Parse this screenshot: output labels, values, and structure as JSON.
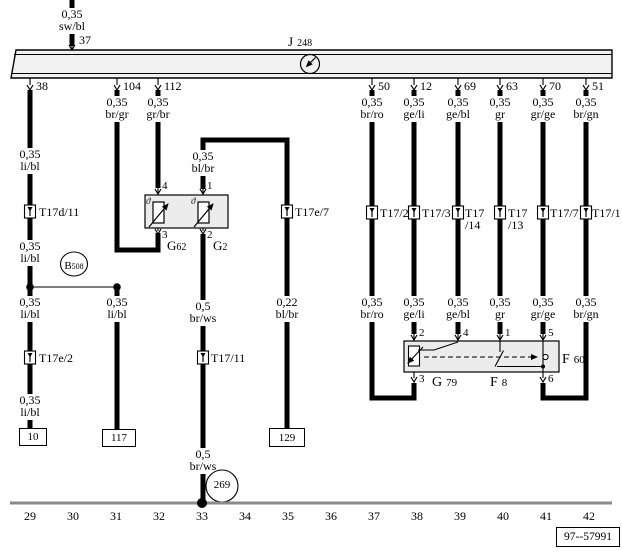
{
  "meta": {
    "diagram_number": "97--57991"
  },
  "bus": {
    "component_letter": "J",
    "component_number": "248",
    "top_pin": "37",
    "pins": [
      "38",
      "104",
      "112",
      "50",
      "12",
      "69",
      "63",
      "70",
      "51"
    ]
  },
  "wires": {
    "sw_bl": {
      "size": "0,35",
      "color": "sw/bl"
    },
    "li_bl": {
      "size": "0,35",
      "color": "li/bl"
    },
    "br_gr": {
      "size": "0,35",
      "color": "br/gr"
    },
    "gr_br": {
      "size": "0,35",
      "color": "gr/br"
    },
    "bl_br": {
      "size": "0,35",
      "color": "bl/br"
    },
    "bl_br_thin": {
      "size": "0,22",
      "color": "bl/br"
    },
    "br_ws": {
      "size": "0,5",
      "color": "br/ws"
    },
    "br_ro": {
      "size": "0,35",
      "color": "br/ro"
    },
    "ge_li": {
      "size": "0,35",
      "color": "ge/li"
    },
    "ge_bl": {
      "size": "0,35",
      "color": "ge/bl"
    },
    "gr": {
      "size": "0,35",
      "color": "gr"
    },
    "gr_ge": {
      "size": "0,35",
      "color": "gr/ge"
    },
    "br_gn": {
      "size": "0,35",
      "color": "br/gn"
    }
  },
  "connectors": {
    "t17d_11": "T17d/11",
    "t17e_2": "T17e/2",
    "t17_11": "T17/11",
    "t17e_7": "T17e/7",
    "t17_2": "T17/2",
    "t17_3": "T17/3",
    "t17_14_line1": "T17",
    "t17_14_line2": "/14",
    "t17_13_line1": "T17",
    "t17_13_line2": "/13",
    "t17_7": "T17/7",
    "t17_1": "T17/1"
  },
  "components": {
    "g62": {
      "letter": "G",
      "number": "62"
    },
    "g2": {
      "letter": "G",
      "number": "2"
    },
    "g79": {
      "letter": "G",
      "number": "79"
    },
    "f8": {
      "letter": "F",
      "number": "8"
    },
    "f60": {
      "letter": "F",
      "number": "60"
    },
    "b508": {
      "letter": "B",
      "number": "508"
    },
    "theta": "ϑ"
  },
  "component_pins": {
    "g62_top": "4",
    "g2_top": "1",
    "g62_bottom": "3",
    "g2_bottom": "2",
    "g79_top": "2",
    "g79_wiper": "4",
    "f8_top": "1",
    "f60_top": "5",
    "g79_bottom": "3",
    "f60_bottom": "6"
  },
  "terminals": {
    "t10": "10",
    "t117": "117",
    "t129": "129",
    "ground_269": "269"
  },
  "tracks": [
    "29",
    "30",
    "31",
    "32",
    "33",
    "34",
    "35",
    "36",
    "37",
    "38",
    "39",
    "40",
    "41",
    "42"
  ]
}
